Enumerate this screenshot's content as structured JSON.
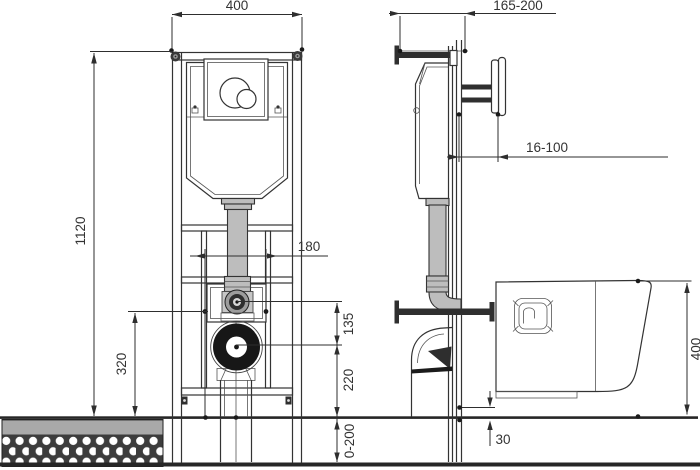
{
  "drawing": {
    "front_view": {
      "width": "400",
      "height": "1120",
      "bolt_spacing": "180",
      "inlet_offset": "135",
      "outlet_height": "220",
      "fixing_height": "320",
      "leg_range": "0-200"
    },
    "side_view": {
      "depth_range": "165-200",
      "wall_distance": "16-100",
      "pan_height": "400",
      "floor_gap": "30"
    },
    "colors": {
      "line": "#333333",
      "dimension": "#2e2e2e",
      "pipe_fill": "#bdbdbd",
      "metal_dark": "#2f2f2f",
      "screed_gray": "#a9a9a9",
      "aggregate_dark": "#3c3c3c",
      "waste_outlet_black": "#171717",
      "background": "#ffffff"
    }
  }
}
